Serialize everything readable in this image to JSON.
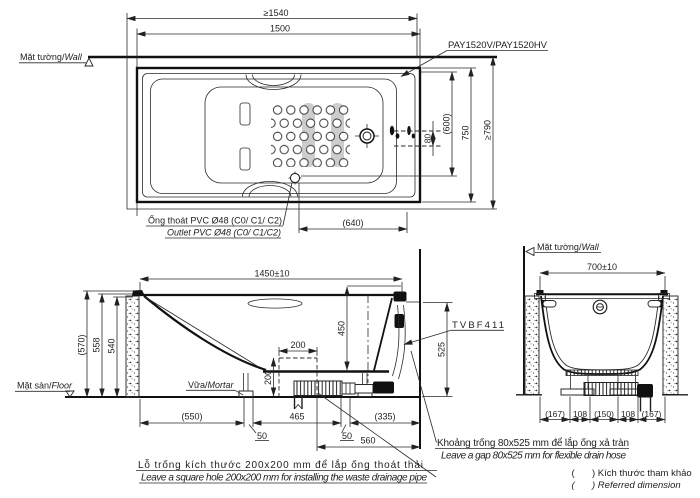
{
  "labels": {
    "model": "PAY1520V/PAY1520HV",
    "valve": "TVBF411",
    "wall_vi": "Mặt tường/",
    "wall_en": "Wall",
    "floor_vi": "Mặt sàn/",
    "floor_en": "Floor",
    "mortar_vi": "Vữa/",
    "mortar_en": "Mortar",
    "outlet_vi": "Ống thoát PVC Ø48 (C0/ C1/ C2)",
    "outlet_en": "Outlet PVC Ø48 (C0/ C1/C2)",
    "hole_vi": "Lỗ trống kích thước 200x200 mm để lắp ống thoát thải",
    "hole_en": "Leave a square hole  200x200 mm for installing the waste drainage pipe",
    "gap_vi": "Khoảng trống 80x525 mm để lắp ống xả tràn",
    "gap_en": "Leave a gap 80x525 mm for flexible drain hose",
    "paren": "(",
    "ref_vi": ") Kích thước tham khảo",
    "ref_en": ") Referred dimension"
  },
  "dims": {
    "plan": {
      "overall_length": "≥1540",
      "length": "1500",
      "deck_offset": "80",
      "inner_width": "(600)",
      "width": "750",
      "overall_width": "≥790",
      "outlet_offset": "(640)"
    },
    "side": {
      "length": "1450±10",
      "h_ref": "(570)",
      "h_rim": "558",
      "h_inner": "540",
      "h_overflow": "450",
      "hole_w": "200",
      "hole_h": "200",
      "gap_h": "525",
      "d1": "(550)",
      "g1": "50",
      "d2": "465",
      "g2": "50",
      "d3": "(335)",
      "d4": "560"
    },
    "end": {
      "width": "700±10",
      "e1": "(167)",
      "e2": "108",
      "e3": "(150)",
      "e4": "108",
      "e5": "(167)"
    }
  }
}
